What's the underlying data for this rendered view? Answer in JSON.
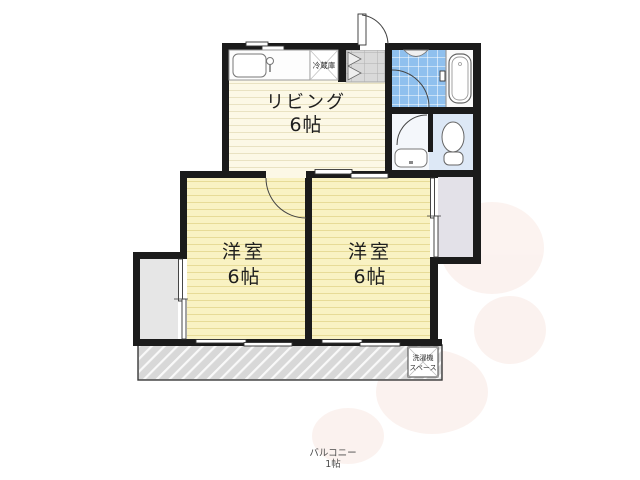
{
  "rooms": {
    "living": {
      "name": "リビング",
      "size": "6帖"
    },
    "bedroom_left": {
      "name": "洋室",
      "size": "6帖"
    },
    "bedroom_right": {
      "name": "洋室",
      "size": "6帖"
    },
    "balcony": {
      "name": "バルコニー",
      "size": "1帖"
    }
  },
  "labels": {
    "refrigerator": "冷蔵庫",
    "washer_line1": "洗濯機",
    "washer_line2": "スペース"
  },
  "colors": {
    "wall": "#1b1b1b",
    "living_floor": "#fcf8e6",
    "bedroom_floor": "#f9f2c3",
    "bath_tile": "#8fc0ee",
    "tub_zone": "#fafafa",
    "toilet_floor": "#dde8f6",
    "washroom_floor": "#f4f7fb",
    "closet_floor": "#e3e1e8",
    "alcove_floor": "#e6e6e6",
    "entrance_floor": "#d9d9d9",
    "balcony_floor": "#d8d8d8",
    "watermark": "#f9e9e3"
  }
}
